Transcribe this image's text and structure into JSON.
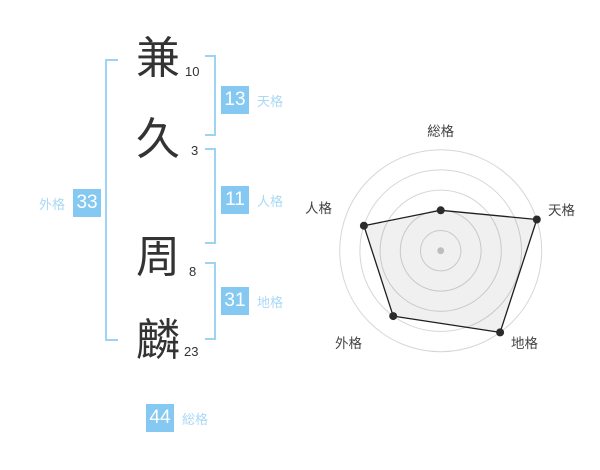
{
  "name_diagram": {
    "characters": [
      {
        "char": "兼",
        "strokes": "10"
      },
      {
        "char": "久",
        "strokes": "3"
      },
      {
        "char": "周",
        "strokes": "8"
      },
      {
        "char": "麟",
        "strokes": "23"
      }
    ],
    "badges": {
      "tenkaku": {
        "value": "13",
        "label": "天格"
      },
      "jinkaku": {
        "value": "11",
        "label": "人格"
      },
      "chikaku": {
        "value": "31",
        "label": "地格"
      },
      "gaikaku": {
        "value": "33",
        "label": "外格"
      },
      "soukaku": {
        "value": "44",
        "label": "総格"
      }
    }
  },
  "chart_data": {
    "type": "radar",
    "categories": [
      "総格",
      "天格",
      "地格",
      "外格",
      "人格"
    ],
    "values": [
      2,
      5,
      5,
      4,
      4
    ],
    "max": 5,
    "rings": 5,
    "angles_deg": [
      90,
      18,
      -54,
      -126,
      162
    ],
    "grid": "concentric-circles",
    "legend": "none",
    "title": ""
  },
  "colors": {
    "badge_blue": "#85c9f3",
    "label_blue": "#a9d9f6",
    "bracket_blue": "#9dd3f4",
    "text_dark": "#333333",
    "radar_grid": "#d6d6d6",
    "radar_line": "#1f1f1f",
    "radar_fill": "rgba(0,0,0,0.06)",
    "radar_dot": "#2b2b2b",
    "radar_center_dot": "#bdbdbd"
  }
}
